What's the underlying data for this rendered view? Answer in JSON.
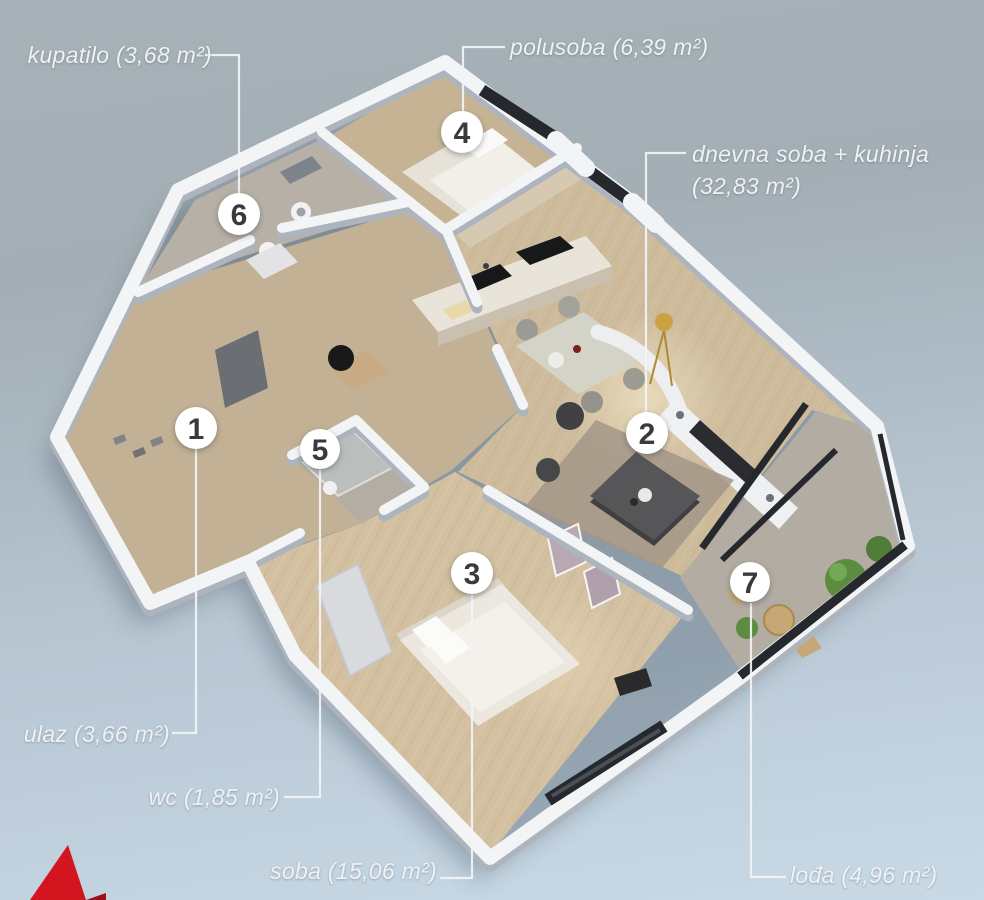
{
  "palette": {
    "background_top": "#a7b2b8",
    "background_bottom": "#c9d9e6",
    "wall_white": "#f3f4f6",
    "wall_shade": "#aeb4bd",
    "window_dark": "#25282c",
    "wood_floor": "#cdbb9c",
    "label_text": "#eef2f5",
    "marker_number": "#3a3a3c",
    "logo_red": "#d31520",
    "logo_red_dark": "#9c0f18"
  },
  "annotations": [
    {
      "id": "kupatilo",
      "label": {
        "text": "kupatilo (3,68 m²)",
        "x": 212,
        "y": 55,
        "align": "right"
      },
      "leader": "205,55 239,55 239,193",
      "marker": {
        "n": "6",
        "x": 239,
        "y": 214,
        "r": 21
      }
    },
    {
      "id": "polusoba",
      "label": {
        "text": "polusoba (6,39 m²)",
        "x": 510,
        "y": 47,
        "align": "left"
      },
      "leader": "505,47 463,47 463,111",
      "marker": {
        "n": "4",
        "x": 462,
        "y": 132,
        "r": 21
      }
    },
    {
      "id": "dnevna-soba-kuhinja",
      "label": {
        "text": "dnevna soba + kuhinja\n(32,83 m²)",
        "x": 692,
        "y": 170,
        "align": "left"
      },
      "leader": "686,153 646,153 646,412",
      "marker": {
        "n": "2",
        "x": 647,
        "y": 433,
        "r": 21
      }
    },
    {
      "id": "ulaz",
      "label": {
        "text": "ulaz (3,66 m²)",
        "x": 170,
        "y": 734,
        "align": "right"
      },
      "leader": "172,733 196,733 196,449",
      "marker": {
        "n": "1",
        "x": 196,
        "y": 428,
        "r": 21
      }
    },
    {
      "id": "wc",
      "label": {
        "text": "wc (1,85 m²)",
        "x": 280,
        "y": 797,
        "align": "right"
      },
      "leader": "284,797 320,797 320,470",
      "marker": {
        "n": "5",
        "x": 320,
        "y": 449,
        "r": 20
      }
    },
    {
      "id": "soba",
      "label": {
        "text": "soba (15,06 m²)",
        "x": 437,
        "y": 871,
        "align": "right"
      },
      "leader": "440,878 472,878 472,595",
      "marker": {
        "n": "3",
        "x": 472,
        "y": 573,
        "r": 21
      }
    },
    {
      "id": "lodja",
      "label": {
        "text": "lođa (4,96 m²)",
        "x": 790,
        "y": 875,
        "align": "left"
      },
      "leader": "786,877 751,877 751,603",
      "marker": {
        "n": "7",
        "x": 750,
        "y": 582,
        "r": 20
      }
    }
  ],
  "logo": {
    "front_color": "#d31520",
    "side_color": "#9c0f18"
  }
}
